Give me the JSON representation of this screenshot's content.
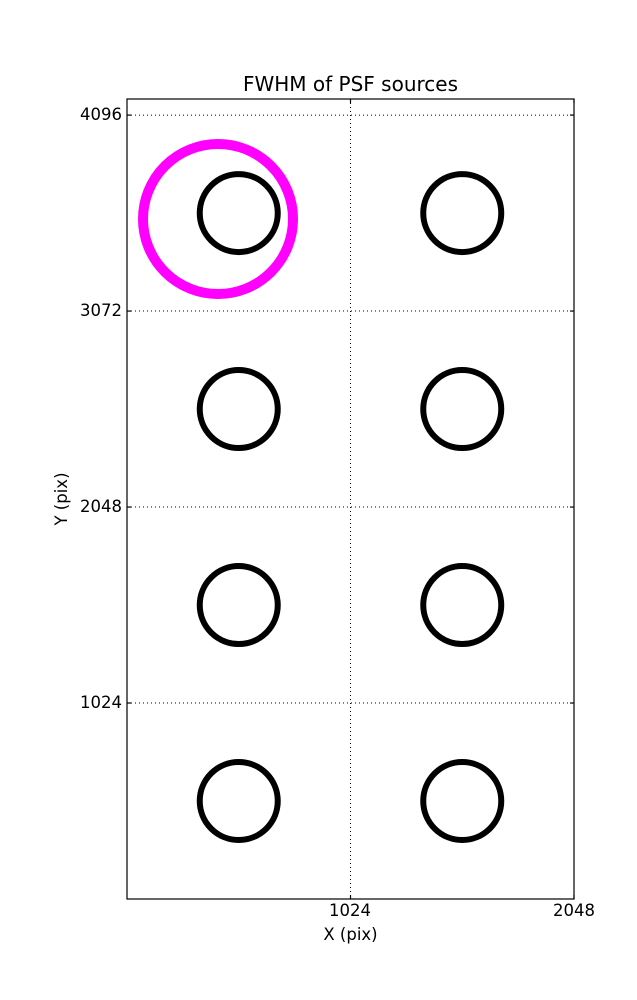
{
  "figure": {
    "background_color": "#ffffff",
    "frame_color": "#000000"
  },
  "chart_data": {
    "type": "scatter",
    "title": "FWHM of PSF sources",
    "xlabel": "X (pix)",
    "ylabel": "Y (pix)",
    "xlim": [
      0,
      2048
    ],
    "ylim": [
      0,
      4180
    ],
    "xticks": [
      1024,
      2048
    ],
    "yticks": [
      1024,
      2048,
      3072,
      4096
    ],
    "tick_labels": {
      "x": [
        "1024",
        "2048"
      ],
      "y": [
        "1024",
        "2048",
        "3072",
        "4096"
      ]
    },
    "grid": "dotted",
    "legend": "none",
    "points": [
      {
        "x": 512,
        "y": 3584
      },
      {
        "x": 1536,
        "y": 3584
      },
      {
        "x": 512,
        "y": 2560
      },
      {
        "x": 1536,
        "y": 2560
      },
      {
        "x": 512,
        "y": 1536
      },
      {
        "x": 1536,
        "y": 1536
      },
      {
        "x": 512,
        "y": 512
      },
      {
        "x": 1536,
        "y": 512
      }
    ],
    "marker": {
      "shape": "circle",
      "radius_px": 39,
      "stroke_px": 6,
      "color": "#000000",
      "fill": "none"
    },
    "highlight": {
      "x": 417,
      "y": 3553,
      "radius_px": 75,
      "stroke_px": 10,
      "color": "#ff00ff",
      "fill": "none"
    }
  }
}
